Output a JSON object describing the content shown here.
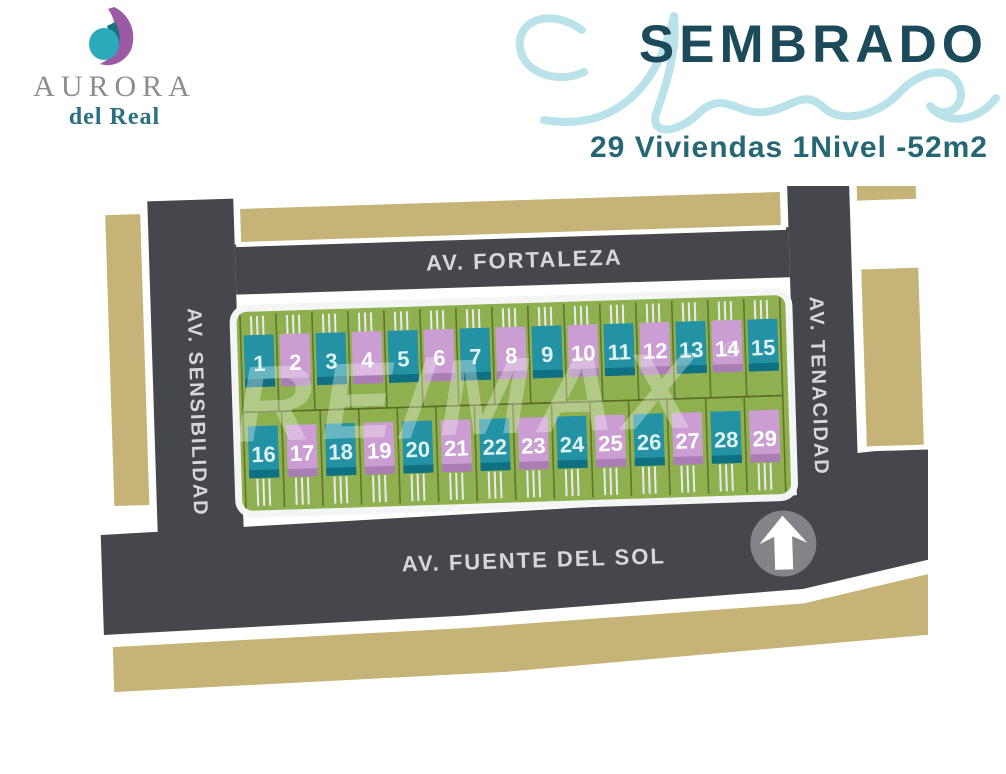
{
  "brand": {
    "name": "AURORA",
    "subname": "del Real",
    "logo_purple": "#9c5aa5",
    "logo_teal": "#2baabb",
    "logo_dark_teal": "#19727f"
  },
  "header": {
    "title": "SEMBRADO",
    "subtitle": "29 Viviendas 1Nivel -52m2",
    "title_color": "#1b4a5a",
    "subtitle_color": "#266776",
    "script_color": "#b3dfe9"
  },
  "map": {
    "streets": {
      "top": "AV. FORTALEZA",
      "left": "AV. SENSIBILIDAD",
      "right": "AV. TENACIDAD",
      "bottom": "AV. FUENTE DEL SOL"
    },
    "watermark": {
      "text": "RE/MAX",
      "reg": "®"
    },
    "colors": {
      "road": "#45474d",
      "road_label": "#d6d7da",
      "block_tan": "#c5b377",
      "lot_green": "#8fb04f",
      "lot_line": "#5a6a24",
      "house_teal": "#2292a4",
      "house_teal_dark": "#0e7080",
      "house_pink": "#cb9dd2",
      "house_pink_dark": "#aa7db5",
      "number_on_teal": "#dff2f5",
      "number_on_pink": "#ffffff",
      "driveway": "#e9eaee",
      "north_circle": "#83848a"
    },
    "lots": {
      "top_row": [
        {
          "n": "1",
          "color": "teal"
        },
        {
          "n": "2",
          "color": "pink"
        },
        {
          "n": "3",
          "color": "teal"
        },
        {
          "n": "4",
          "color": "pink"
        },
        {
          "n": "5",
          "color": "teal"
        },
        {
          "n": "6",
          "color": "pink"
        },
        {
          "n": "7",
          "color": "teal"
        },
        {
          "n": "8",
          "color": "pink"
        },
        {
          "n": "9",
          "color": "teal"
        },
        {
          "n": "10",
          "color": "pink"
        },
        {
          "n": "11",
          "color": "teal"
        },
        {
          "n": "12",
          "color": "pink"
        },
        {
          "n": "13",
          "color": "teal"
        },
        {
          "n": "14",
          "color": "pink"
        },
        {
          "n": "15",
          "color": "teal"
        }
      ],
      "bottom_row": [
        {
          "n": "16",
          "color": "teal"
        },
        {
          "n": "17",
          "color": "pink"
        },
        {
          "n": "18",
          "color": "teal"
        },
        {
          "n": "19",
          "color": "pink"
        },
        {
          "n": "20",
          "color": "teal"
        },
        {
          "n": "21",
          "color": "pink"
        },
        {
          "n": "22",
          "color": "teal"
        },
        {
          "n": "23",
          "color": "pink"
        },
        {
          "n": "24",
          "color": "teal"
        },
        {
          "n": "25",
          "color": "pink"
        },
        {
          "n": "26",
          "color": "teal"
        },
        {
          "n": "27",
          "color": "pink"
        },
        {
          "n": "28",
          "color": "teal"
        },
        {
          "n": "29",
          "color": "pink"
        }
      ]
    }
  },
  "icons": {
    "logo": "aurora-moon-logo",
    "flourish": "script-flourish",
    "north": "north-arrow-icon"
  }
}
